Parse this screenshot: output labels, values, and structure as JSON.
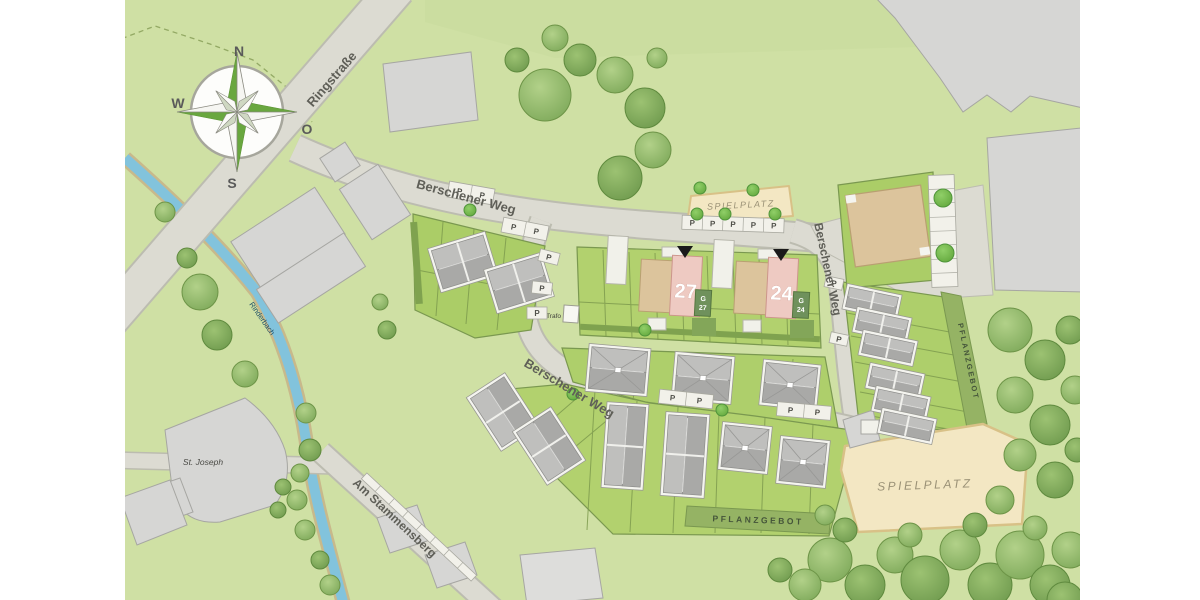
{
  "compass": {
    "north": "N",
    "east": "O",
    "south": "S",
    "west": "W"
  },
  "streets": {
    "ringstrasse": "Ringstraße",
    "berschener_weg": "Berschener Weg",
    "am_stammensberg": "Am Stammensberg"
  },
  "water": {
    "stream": "Rinderbach"
  },
  "labels": {
    "parking": "P",
    "trafo": "Trafo",
    "st_joseph": "St. Joseph",
    "spielplatz": "SPIELPLATZ",
    "pflanzgebot": "PFLANZGEBOT",
    "garage": "G"
  },
  "plots": {
    "plot27": "27",
    "plot24": "24"
  },
  "colors": {
    "meadow": "#cfe0a4",
    "road": "#dcdbd2",
    "road_edge": "#b9b9ac",
    "plot_green": "#aecf6b",
    "hedge_green": "#7fa24f",
    "planting_strip": "#95b364",
    "sand": "#f3e7c3",
    "water": "#82c3dc",
    "building_gray": "#d6d6d4",
    "roof_gray": "#b0b0ae",
    "tan_building": "#dcc49c",
    "plot_pink": "#eecac2",
    "garage_green": "#6f915c",
    "tree_green": "#8fb468",
    "compass_green": "#69a73f",
    "label_gray": "#5f5f58"
  }
}
